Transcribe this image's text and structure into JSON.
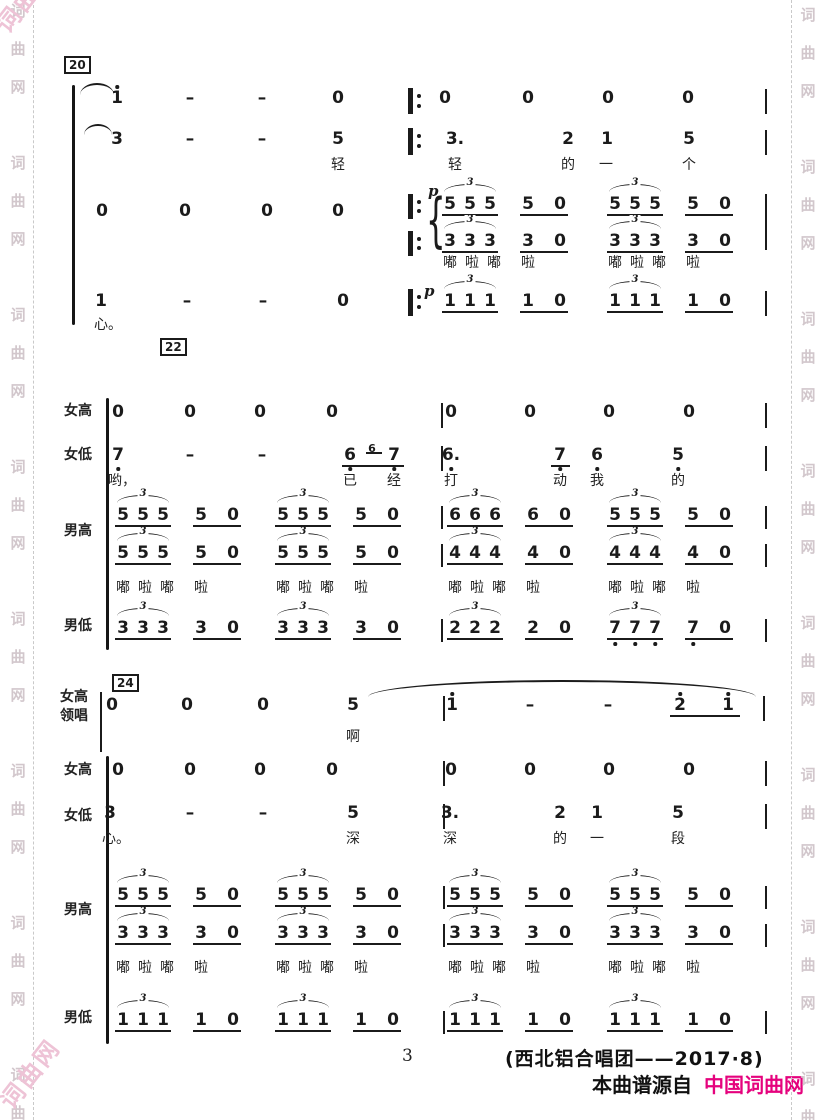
{
  "page": {
    "width": 826,
    "height": 1120,
    "bg": "#ffffff",
    "ink": "#1b1b1b"
  },
  "watermark": {
    "chars": [
      "词",
      "曲",
      "网"
    ],
    "color": "#d2c7cc",
    "corner_color": "#eec3d6",
    "corner_text": "词曲网",
    "left_x": 18,
    "right_x": 808,
    "left_dash_x": 33,
    "right_dash_x": 791,
    "start_y": 4,
    "char_step": 38,
    "group_step": 152,
    "groups": 8
  },
  "footer": {
    "page_number": "3",
    "credit": "(西北铝合唱团——2017·8)",
    "source_prefix": "本曲谱源自",
    "source_site": "中国词曲网",
    "site_color": "#e5027d"
  },
  "score": {
    "boxes": [
      {
        "t": "20",
        "x": 64,
        "y": 56
      },
      {
        "t": "22",
        "x": 160,
        "y": 338
      },
      {
        "t": "24",
        "x": 112,
        "y": 674
      }
    ],
    "labels": [
      {
        "t": "女高",
        "x": 64,
        "y": 404
      },
      {
        "t": "女低",
        "x": 64,
        "y": 448
      },
      {
        "t": "男高",
        "x": 64,
        "y": 524
      },
      {
        "t": "男低",
        "x": 64,
        "y": 619
      },
      {
        "t": "女高",
        "x": 60,
        "y": 690
      },
      {
        "t": "领唱",
        "x": 60,
        "y": 709
      },
      {
        "t": "女高",
        "x": 64,
        "y": 763
      },
      {
        "t": "女低",
        "x": 64,
        "y": 809
      },
      {
        "t": "男高",
        "x": 64,
        "y": 903
      },
      {
        "t": "男低",
        "x": 64,
        "y": 1011
      }
    ],
    "brackets": [
      {
        "x": 72,
        "y": 85,
        "h": 240
      },
      {
        "x": 106,
        "y": 398,
        "h": 252
      },
      {
        "x": 106,
        "y": 756,
        "h": 288
      }
    ],
    "vlines": [
      {
        "x": 765,
        "y": 89,
        "h": 25
      },
      {
        "x": 765,
        "y": 130,
        "h": 25
      },
      {
        "x": 765,
        "y": 194,
        "h": 56
      },
      {
        "x": 765,
        "y": 291,
        "h": 25
      },
      {
        "x": 441,
        "y": 403,
        "h": 25
      },
      {
        "x": 441,
        "y": 446,
        "h": 25
      },
      {
        "x": 441,
        "y": 506,
        "h": 23
      },
      {
        "x": 441,
        "y": 544,
        "h": 23
      },
      {
        "x": 441,
        "y": 619,
        "h": 23
      },
      {
        "x": 765,
        "y": 403,
        "h": 25
      },
      {
        "x": 765,
        "y": 446,
        "h": 25
      },
      {
        "x": 765,
        "y": 506,
        "h": 23
      },
      {
        "x": 765,
        "y": 544,
        "h": 23
      },
      {
        "x": 765,
        "y": 619,
        "h": 23
      },
      {
        "x": 100,
        "y": 692,
        "h": 60
      },
      {
        "x": 443,
        "y": 696,
        "h": 25
      },
      {
        "x": 443,
        "y": 761,
        "h": 25
      },
      {
        "x": 443,
        "y": 804,
        "h": 25
      },
      {
        "x": 443,
        "y": 886,
        "h": 23
      },
      {
        "x": 443,
        "y": 924,
        "h": 23
      },
      {
        "x": 443,
        "y": 1011,
        "h": 23
      },
      {
        "x": 763,
        "y": 696,
        "h": 25
      },
      {
        "x": 765,
        "y": 761,
        "h": 25
      },
      {
        "x": 765,
        "y": 804,
        "h": 25
      },
      {
        "x": 765,
        "y": 886,
        "h": 23
      },
      {
        "x": 765,
        "y": 924,
        "h": 23
      },
      {
        "x": 765,
        "y": 1011,
        "h": 23
      }
    ],
    "repeats": [
      {
        "x": 408,
        "y": 88,
        "h": 26
      },
      {
        "x": 408,
        "y": 128,
        "h": 27
      },
      {
        "x": 408,
        "y": 194,
        "h": 25
      },
      {
        "x": 408,
        "y": 231,
        "h": 25
      },
      {
        "x": 408,
        "y": 289,
        "h": 27
      }
    ],
    "braces": [
      {
        "x": 426,
        "y": 192,
        "h": 56
      }
    ],
    "dyns": [
      {
        "t": "p",
        "x": 428,
        "y": 184
      },
      {
        "t": "p",
        "x": 424,
        "y": 284
      }
    ],
    "notes": [
      {
        "t": "1",
        "x": 117,
        "y": 90,
        "da": 1
      },
      {
        "t": "–",
        "x": 190,
        "y": 90
      },
      {
        "t": "–",
        "x": 262,
        "y": 90
      },
      {
        "t": "0",
        "x": 338,
        "y": 90
      },
      {
        "t": "0",
        "x": 445,
        "y": 90
      },
      {
        "t": "0",
        "x": 528,
        "y": 90
      },
      {
        "t": "0",
        "x": 608,
        "y": 90
      },
      {
        "t": "0",
        "x": 688,
        "y": 90
      },
      {
        "t": "3",
        "x": 117,
        "y": 131
      },
      {
        "t": "–",
        "x": 190,
        "y": 131
      },
      {
        "t": "–",
        "x": 262,
        "y": 131
      },
      {
        "t": "5",
        "x": 338,
        "y": 131
      },
      {
        "t": "3.",
        "x": 455,
        "y": 131
      },
      {
        "t": "2",
        "x": 568,
        "y": 131
      },
      {
        "t": "1",
        "x": 607,
        "y": 131
      },
      {
        "t": "5",
        "x": 689,
        "y": 131
      },
      {
        "t": "0",
        "x": 102,
        "y": 203
      },
      {
        "t": "0",
        "x": 185,
        "y": 203
      },
      {
        "t": "0",
        "x": 267,
        "y": 203
      },
      {
        "t": "0",
        "x": 338,
        "y": 203
      },
      {
        "t": "1",
        "x": 101,
        "y": 293
      },
      {
        "t": "–",
        "x": 187,
        "y": 293
      },
      {
        "t": "–",
        "x": 263,
        "y": 293
      },
      {
        "t": "0",
        "x": 343,
        "y": 293
      },
      {
        "t": "0",
        "x": 118,
        "y": 404
      },
      {
        "t": "0",
        "x": 190,
        "y": 404
      },
      {
        "t": "0",
        "x": 260,
        "y": 404
      },
      {
        "t": "0",
        "x": 332,
        "y": 404
      },
      {
        "t": "0",
        "x": 451,
        "y": 404
      },
      {
        "t": "0",
        "x": 530,
        "y": 404
      },
      {
        "t": "0",
        "x": 609,
        "y": 404
      },
      {
        "t": "0",
        "x": 689,
        "y": 404
      },
      {
        "t": "7",
        "x": 118,
        "y": 447,
        "db": 1
      },
      {
        "t": "–",
        "x": 190,
        "y": 447
      },
      {
        "t": "–",
        "x": 262,
        "y": 447
      },
      {
        "t": "6",
        "x": 350,
        "y": 447,
        "db": 1
      },
      {
        "t": "6",
        "x": 372,
        "y": 443,
        "sm": 1
      },
      {
        "t": "7",
        "x": 394,
        "y": 447,
        "db": 1
      },
      {
        "t": "6.",
        "x": 451,
        "y": 447,
        "db": 1
      },
      {
        "t": "7",
        "x": 560,
        "y": 447,
        "db": 1
      },
      {
        "t": "6",
        "x": 597,
        "y": 447,
        "db": 1
      },
      {
        "t": "5",
        "x": 678,
        "y": 447,
        "db": 1
      },
      {
        "t": "0",
        "x": 112,
        "y": 697
      },
      {
        "t": "0",
        "x": 187,
        "y": 697
      },
      {
        "t": "0",
        "x": 263,
        "y": 697
      },
      {
        "t": "5",
        "x": 353,
        "y": 697
      },
      {
        "t": "1",
        "x": 452,
        "y": 697,
        "da": 1
      },
      {
        "t": "–",
        "x": 530,
        "y": 697
      },
      {
        "t": "–",
        "x": 608,
        "y": 697
      },
      {
        "t": "2",
        "x": 680,
        "y": 697,
        "da": 1
      },
      {
        "t": "1",
        "x": 728,
        "y": 697,
        "da": 1
      },
      {
        "t": "0",
        "x": 118,
        "y": 762
      },
      {
        "t": "0",
        "x": 190,
        "y": 762
      },
      {
        "t": "0",
        "x": 260,
        "y": 762
      },
      {
        "t": "0",
        "x": 332,
        "y": 762
      },
      {
        "t": "0",
        "x": 451,
        "y": 762
      },
      {
        "t": "0",
        "x": 530,
        "y": 762
      },
      {
        "t": "0",
        "x": 609,
        "y": 762
      },
      {
        "t": "0",
        "x": 689,
        "y": 762
      },
      {
        "t": "3",
        "x": 110,
        "y": 805
      },
      {
        "t": "–",
        "x": 190,
        "y": 805
      },
      {
        "t": "–",
        "x": 263,
        "y": 805
      },
      {
        "t": "5",
        "x": 353,
        "y": 805
      },
      {
        "t": "3.",
        "x": 450,
        "y": 805
      },
      {
        "t": "2",
        "x": 560,
        "y": 805
      },
      {
        "t": "1",
        "x": 597,
        "y": 805
      },
      {
        "t": "5",
        "x": 678,
        "y": 805
      }
    ],
    "lyrics": [
      {
        "t": "轻",
        "x": 338,
        "y": 158
      },
      {
        "t": "轻",
        "x": 455,
        "y": 158
      },
      {
        "t": "的",
        "x": 568,
        "y": 158
      },
      {
        "t": "一",
        "x": 606,
        "y": 158
      },
      {
        "t": "个",
        "x": 689,
        "y": 158
      },
      {
        "t": "心。",
        "x": 108,
        "y": 318
      },
      {
        "t": "哟，",
        "x": 122,
        "y": 474
      },
      {
        "t": "已",
        "x": 350,
        "y": 474
      },
      {
        "t": "经",
        "x": 394,
        "y": 474
      },
      {
        "t": "打",
        "x": 451,
        "y": 474
      },
      {
        "t": "动",
        "x": 560,
        "y": 474
      },
      {
        "t": "我",
        "x": 597,
        "y": 474
      },
      {
        "t": "的",
        "x": 678,
        "y": 474
      },
      {
        "t": "啊",
        "x": 353,
        "y": 730
      },
      {
        "t": "心。",
        "x": 116,
        "y": 832
      },
      {
        "t": "深",
        "x": 353,
        "y": 832
      },
      {
        "t": "深",
        "x": 450,
        "y": 832
      },
      {
        "t": "的",
        "x": 560,
        "y": 832
      },
      {
        "t": "一",
        "x": 597,
        "y": 832
      },
      {
        "t": "段",
        "x": 678,
        "y": 832
      }
    ],
    "beams": [
      {
        "x1": 342,
        "x2": 404,
        "y": 465
      },
      {
        "x1": 366,
        "x2": 382,
        "y": 452
      },
      {
        "x1": 551,
        "x2": 570,
        "y": 465
      },
      {
        "x1": 670,
        "x2": 740,
        "y": 715
      }
    ],
    "arcs": [
      {
        "x1": 80,
        "x2": 114,
        "y": 83,
        "h": 10
      },
      {
        "x1": 84,
        "x2": 112,
        "y": 124,
        "h": 9
      },
      {
        "x1": 368,
        "x2": 756,
        "y": 680,
        "h": 15
      }
    ],
    "fig": {
      "scat": [
        "嘟",
        "啦",
        "嘟",
        "啦"
      ],
      "triplet_label": "3",
      "rows": [
        {
          "y": 196,
          "groups": [
            {
              "x0": 450,
              "n": "5"
            },
            {
              "x0": 615,
              "n": "5"
            }
          ]
        },
        {
          "y": 233,
          "lyric_y": 256,
          "groups": [
            {
              "x0": 450,
              "n": "3"
            },
            {
              "x0": 615,
              "n": "3"
            }
          ]
        },
        {
          "y": 293,
          "groups": [
            {
              "x0": 450,
              "n": "1"
            },
            {
              "x0": 615,
              "n": "1"
            }
          ]
        },
        {
          "y": 507,
          "groups": [
            {
              "x0": 123,
              "n": "5"
            },
            {
              "x0": 283,
              "n": "5"
            },
            {
              "x0": 455,
              "n": "6"
            },
            {
              "x0": 615,
              "n": "5"
            }
          ]
        },
        {
          "y": 545,
          "lyric_y": 581,
          "groups": [
            {
              "x0": 123,
              "n": "5"
            },
            {
              "x0": 283,
              "n": "5"
            },
            {
              "x0": 455,
              "n": "4"
            },
            {
              "x0": 615,
              "n": "4"
            }
          ]
        },
        {
          "y": 620,
          "groups": [
            {
              "x0": 123,
              "n": "3"
            },
            {
              "x0": 283,
              "n": "3"
            },
            {
              "x0": 455,
              "n": "2"
            },
            {
              "x0": 615,
              "n": "7",
              "db": 1
            }
          ]
        },
        {
          "y": 887,
          "groups": [
            {
              "x0": 123,
              "n": "5"
            },
            {
              "x0": 283,
              "n": "5"
            },
            {
              "x0": 455,
              "n": "5"
            },
            {
              "x0": 615,
              "n": "5"
            }
          ]
        },
        {
          "y": 925,
          "lyric_y": 961,
          "groups": [
            {
              "x0": 123,
              "n": "3"
            },
            {
              "x0": 283,
              "n": "3"
            },
            {
              "x0": 455,
              "n": "3"
            },
            {
              "x0": 615,
              "n": "3"
            }
          ]
        },
        {
          "y": 1012,
          "groups": [
            {
              "x0": 123,
              "n": "1"
            },
            {
              "x0": 283,
              "n": "1"
            },
            {
              "x0": 455,
              "n": "1"
            },
            {
              "x0": 615,
              "n": "1"
            }
          ]
        }
      ]
    }
  }
}
